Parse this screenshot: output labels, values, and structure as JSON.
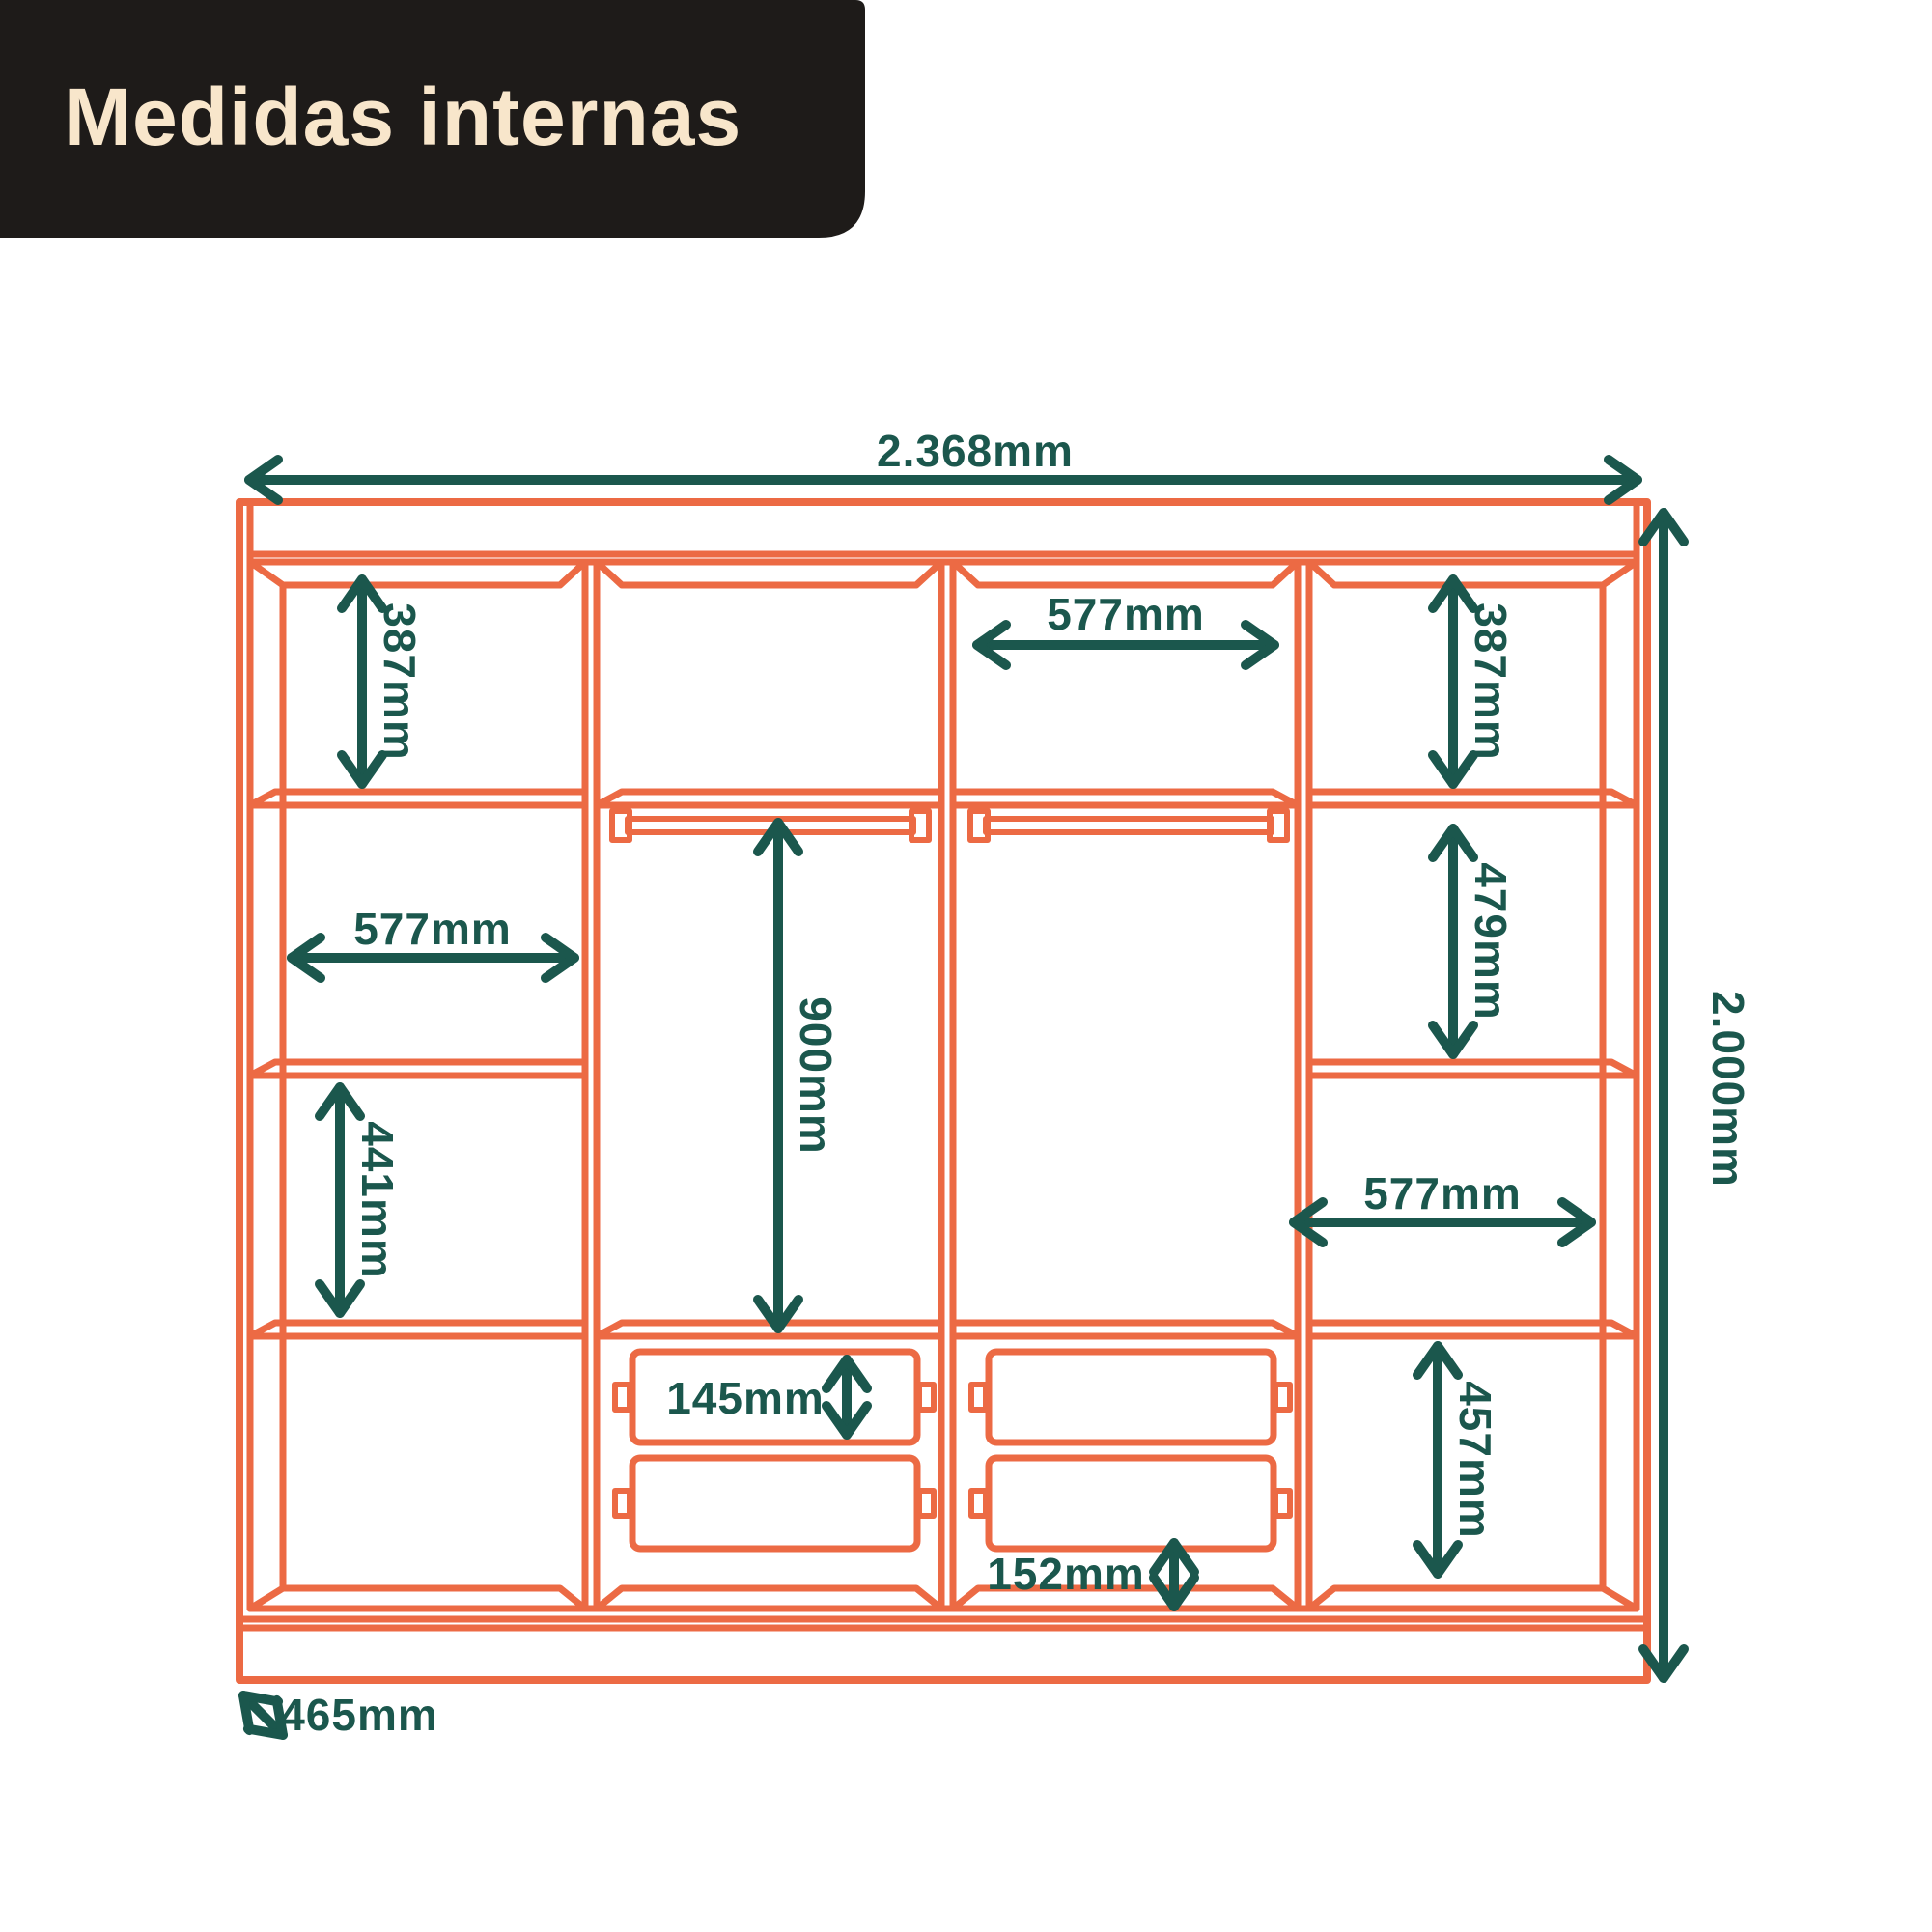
{
  "title": "Medidas internas",
  "colors": {
    "background": "#FFFFFF",
    "line_orange": "#EC6A44",
    "dimension_teal": "#1B574D",
    "title_panel_bg": "#1E1B19",
    "title_text": "#F8E6CB"
  },
  "diagram": {
    "type": "furniture-internal-dimensions",
    "labels": {
      "total_width": "2.368mm",
      "total_height": "2.000mm",
      "depth": "465mm",
      "col1_top_cell_height": "387mm",
      "col1_mid_cell_width": "577mm",
      "col1_lower_cell_height": "441mm",
      "col2_hanging_height": "900mm",
      "col2_drawer_height": "145mm",
      "col3_top_cell_width": "577mm",
      "col3_bottom_gap_height": "152mm",
      "col4_top_cell_height": "387mm",
      "col4_upper_cell_height": "479mm",
      "col4_mid_cell_width": "577mm",
      "col4_lower_cell_height": "457mm"
    }
  }
}
